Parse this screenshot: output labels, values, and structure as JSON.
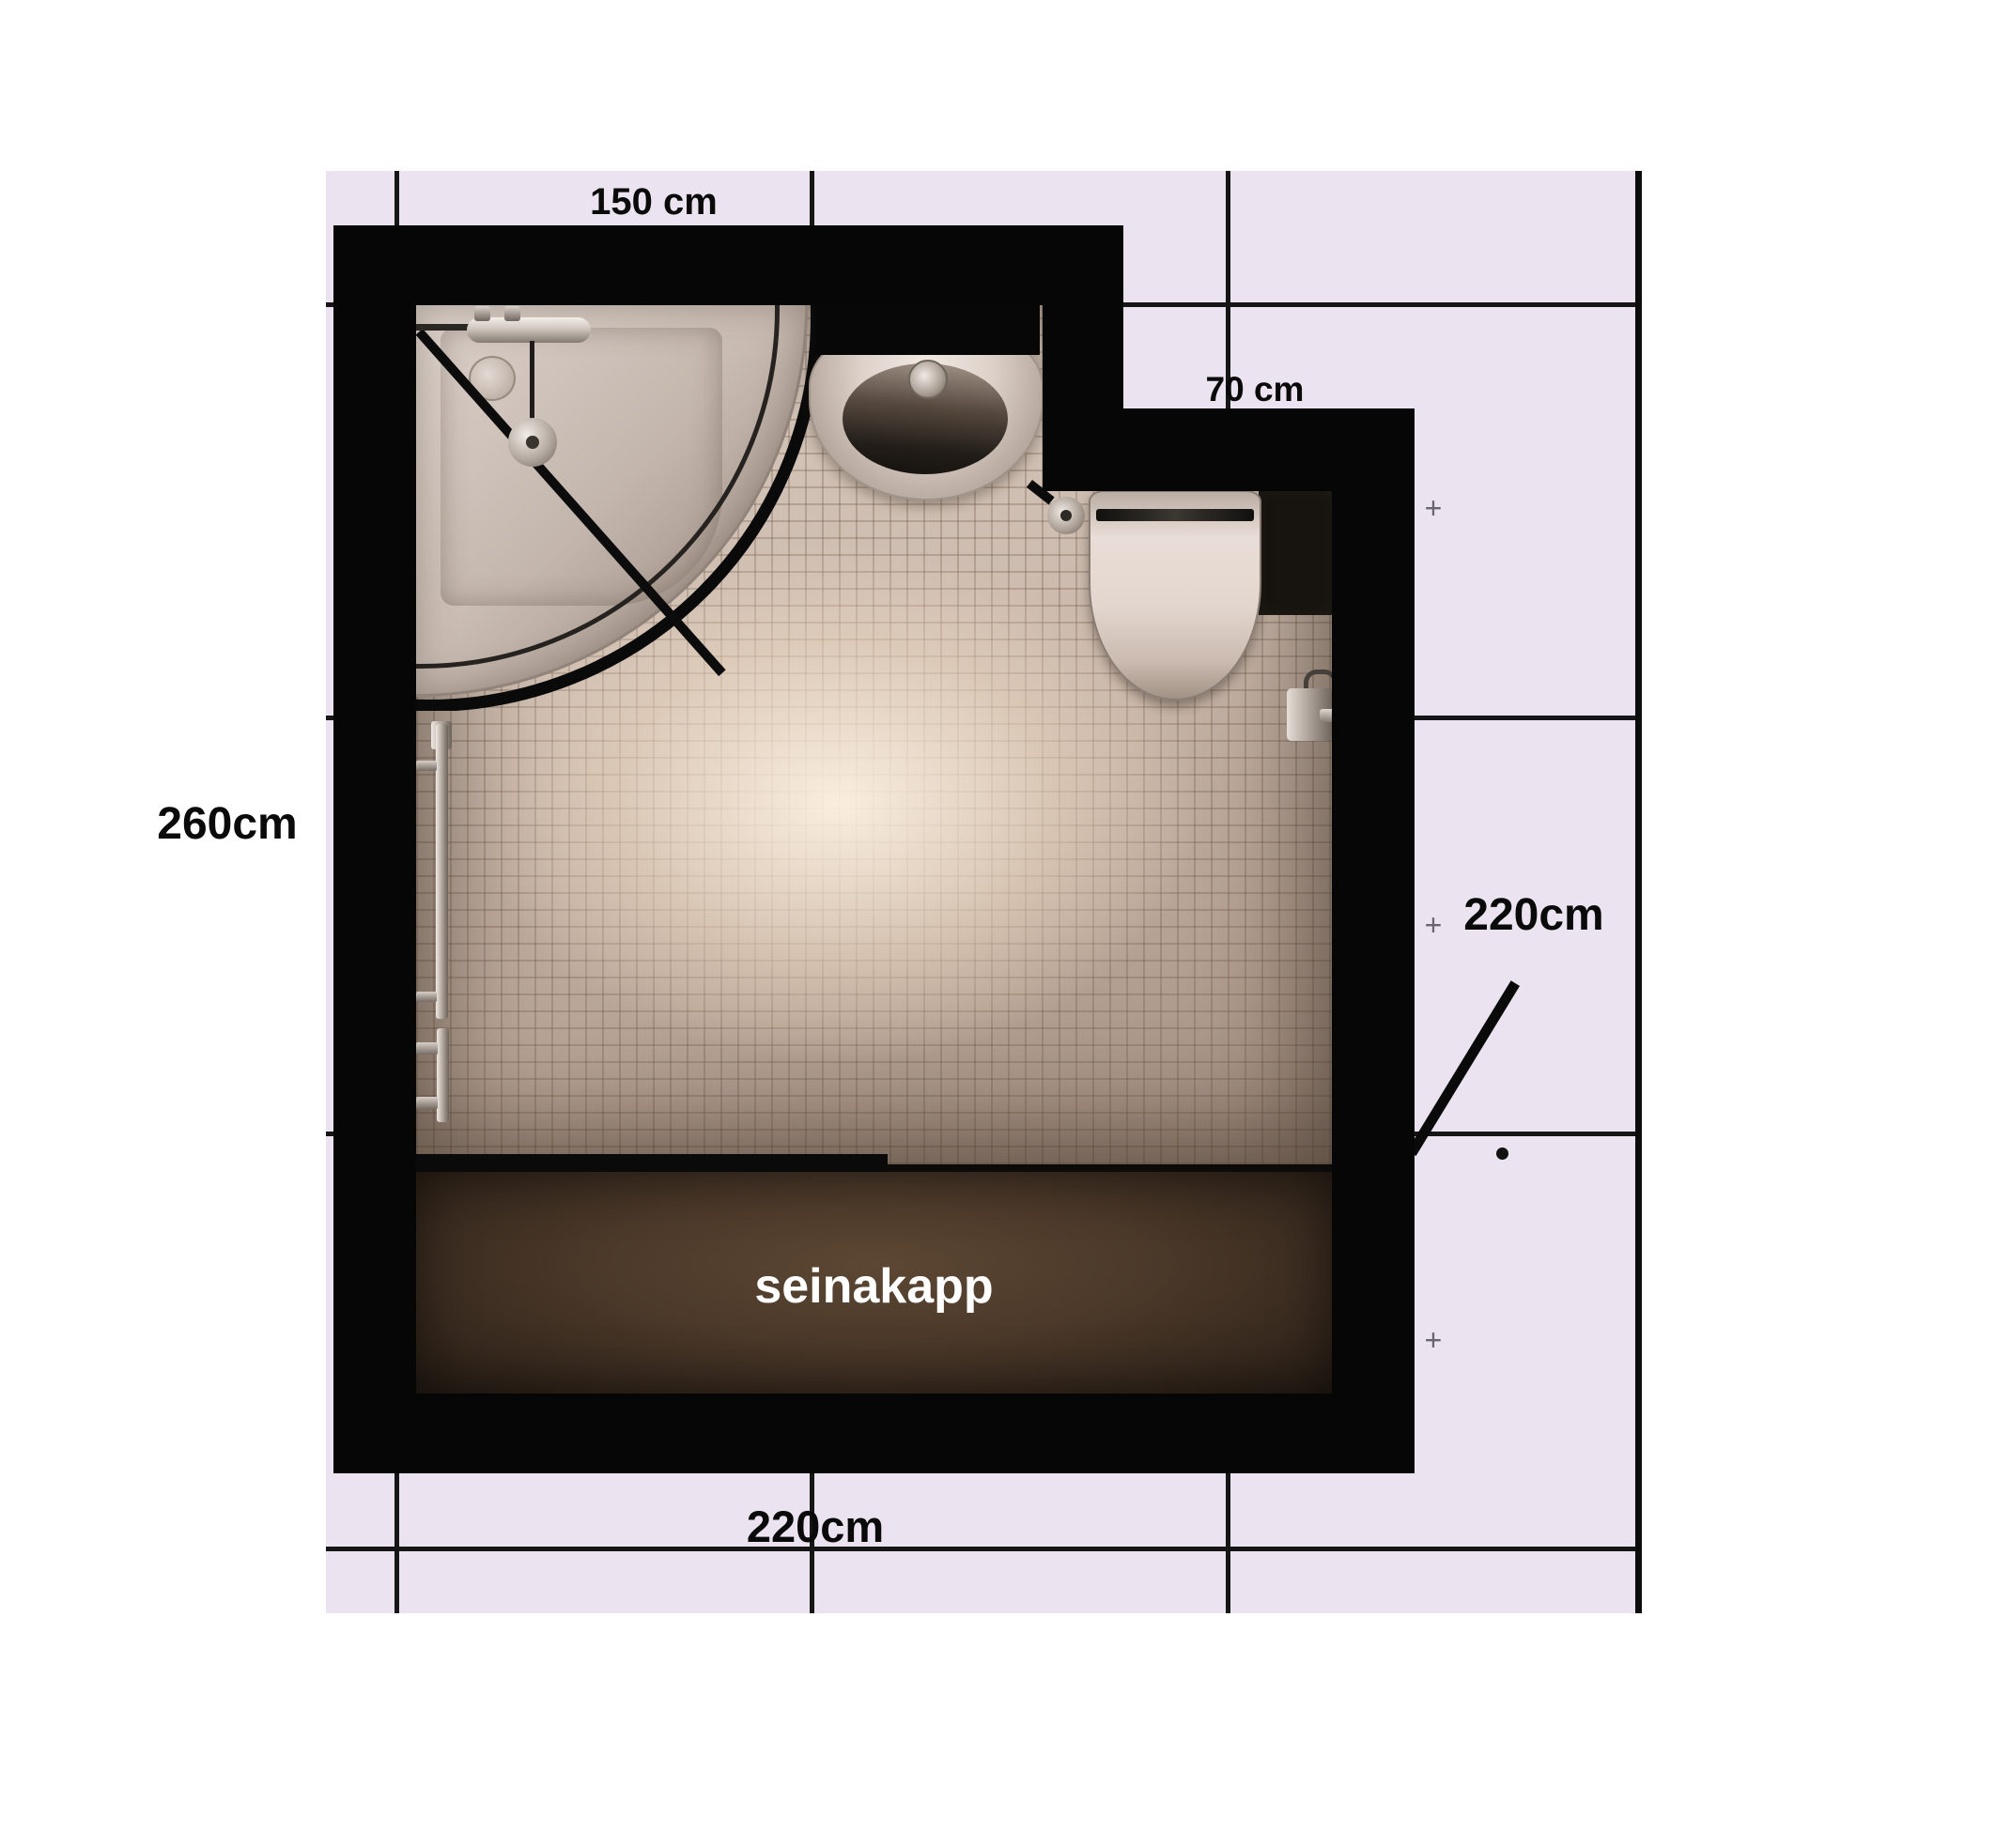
{
  "labels": {
    "top_width": "150 cm",
    "notch_width": "70 cm",
    "left_height": "260cm",
    "right_height": "220cm",
    "bottom_width": "220cm",
    "cabinet": "seinakapp"
  },
  "marks": {
    "plus": "+"
  },
  "plan": {
    "type": "bathroom-floor-plan",
    "room_width_cm": "220",
    "room_height_cm": "260",
    "top_wall_cm": "150",
    "notch_cm": "70",
    "right_wall_cm": "220",
    "fixtures": [
      "corner shower",
      "washbasin",
      "toilet",
      "wall cabinet",
      "towel rails",
      "toilet paper holder"
    ]
  },
  "colors": {
    "page_background": "#ffffff",
    "grid_background": "#ece3f0",
    "grid_line": "#161616",
    "wall": "#060606",
    "floor_tile": "#c6b5a8",
    "cabinet": "#4a3829",
    "cabinet_text": "#ffffff",
    "fixture_ceramic": "#e2d6ce",
    "chrome": "#cfc5bd",
    "label_text": "#0a0a0a"
  }
}
